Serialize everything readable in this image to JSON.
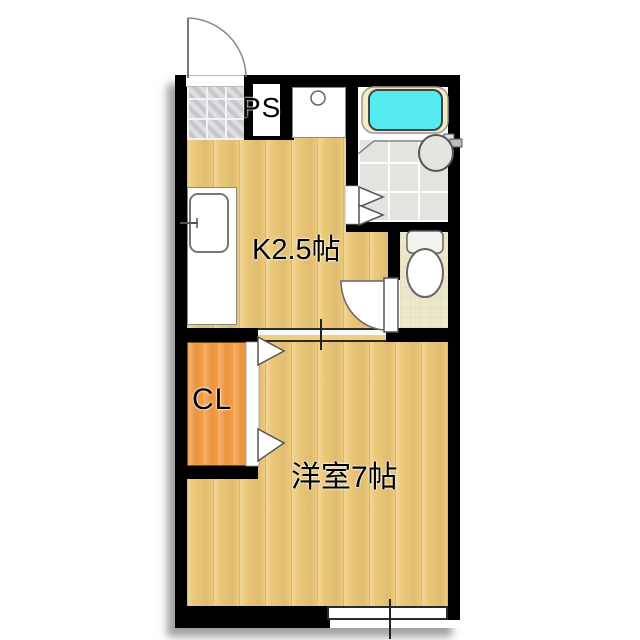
{
  "floorplan": {
    "title": "1K apartment floor plan",
    "rooms": {
      "kitchen": {
        "label": "K2.5帖"
      },
      "western_room": {
        "label": "洋室7帖"
      },
      "closet": {
        "label": "CL"
      },
      "pipe_space": {
        "label": "PS"
      }
    },
    "fixtures": [
      "entry-door",
      "genkan-tile-floor",
      "kitchen-counter",
      "kitchen-sink",
      "washing-machine-pan",
      "bathtub",
      "bathroom-sink",
      "bathroom-folding-door",
      "toilet",
      "toilet-door",
      "closet-folding-door",
      "sliding-window",
      "room-opening"
    ],
    "colors": {
      "wall": "#000000",
      "wood_floor": "#ecc878",
      "closet_fill": "#f39b43",
      "bathtub_water": "#55ebee",
      "bathtub_rim": "#f3ecc5",
      "bath_tile": "#e3e3df",
      "toilet_floor": "#ebe8ca",
      "genkan_tile": "#cdced3"
    }
  }
}
